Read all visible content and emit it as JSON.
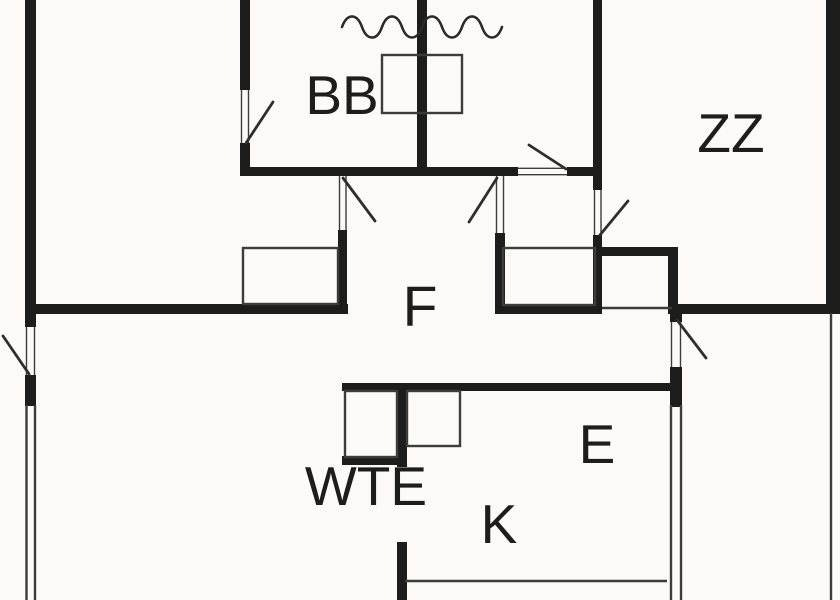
{
  "rooms": {
    "bb": "BB",
    "zz": "ZZ",
    "f": "F",
    "wte": "WTE",
    "e": "E",
    "k": "K"
  },
  "colors": {
    "background": "#fbfaf6",
    "wall": "#1d1d1b",
    "thin": "#3c3c39",
    "swing": "#2e2e2b"
  }
}
